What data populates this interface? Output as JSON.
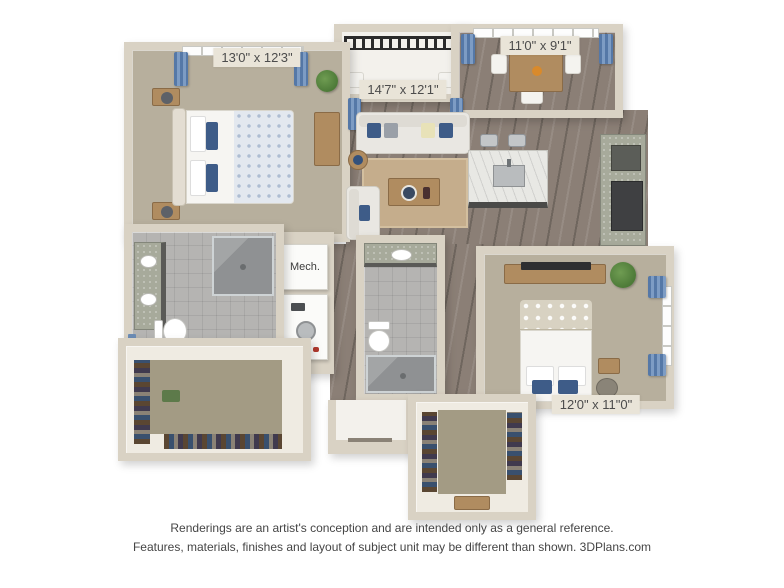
{
  "plan": {
    "rooms": [
      {
        "name": "bedroom-1",
        "dimensions": "13'0\" x 12'3\""
      },
      {
        "name": "living-room",
        "dimensions": "14'7\" x 12'1\""
      },
      {
        "name": "dining-kitchen",
        "dimensions": "11'0\" x 9'1\""
      },
      {
        "name": "bedroom-2",
        "dimensions": "12'0\" x 11\"0\""
      },
      {
        "name": "mechanical-closet",
        "label": "Mech."
      }
    ]
  },
  "footer": {
    "line1": "Renderings are an artist's conception and are intended only as a general reference.",
    "line2": "Features, materials, finishes and layout of subject unit may be different than shown. 3DPlans.com"
  },
  "colors": {
    "wall": "#d9d2c4",
    "wood": "#8b7f76",
    "carpet": "#b7af9d",
    "closet-carpet": "#a39b84",
    "tile": "#b5b4b2",
    "granite": "#a7aa9b",
    "marble": "#e8e8e4",
    "curtain": "#5578a7",
    "rug": "#c5ad8c",
    "plant": "#4d7a38",
    "label-bg": "#e9e4d8",
    "label-text": "#4c4c4c",
    "railing": "#2b2b2b"
  }
}
